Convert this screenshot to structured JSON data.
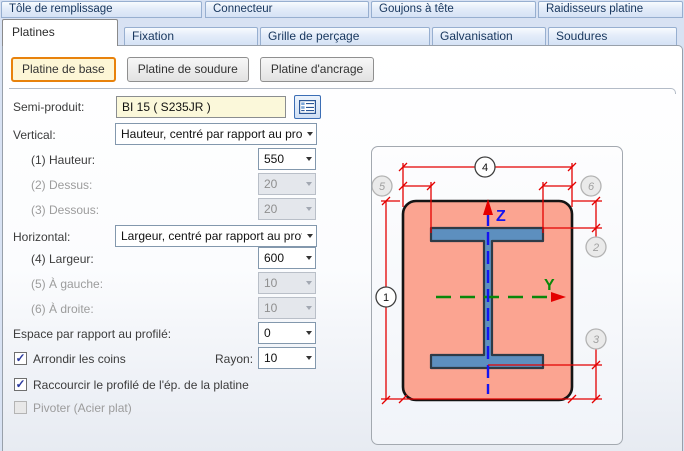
{
  "tabs_row1": [
    {
      "label": "Tôle de remplissage"
    },
    {
      "label": "Connecteur"
    },
    {
      "label": "Goujons à tête"
    },
    {
      "label": "Raidisseurs platine"
    }
  ],
  "tabs_row2": [
    {
      "label": "Platines",
      "active": true
    },
    {
      "label": "Fixation"
    },
    {
      "label": "Grille de perçage"
    },
    {
      "label": "Galvanisation"
    },
    {
      "label": "Soudures"
    }
  ],
  "plate_buttons": [
    {
      "label": "Platine de base",
      "active": true
    },
    {
      "label": "Platine de soudure"
    },
    {
      "label": "Platine d'ancrage"
    }
  ],
  "form": {
    "semi_produit": {
      "label": "Semi-produit:",
      "value": "BI 15  ( S235JR )"
    },
    "vertical": {
      "label": "Vertical:",
      "value": "Hauteur, centré par rapport au profilé"
    },
    "hauteur": {
      "label": "(1) Hauteur:",
      "value": "550"
    },
    "dessus": {
      "label": "(2) Dessus:",
      "value": "20"
    },
    "dessous": {
      "label": "(3) Dessous:",
      "value": "20"
    },
    "horizontal": {
      "label": "Horizontal:",
      "value": "Largeur, centré par rapport au profilé"
    },
    "largeur": {
      "label": "(4) Largeur:",
      "value": "600"
    },
    "a_gauche": {
      "label": "(5) À gauche:",
      "value": "10"
    },
    "a_droite": {
      "label": "(6) À droite:",
      "value": "10"
    },
    "espace": {
      "label": "Espace par rapport au profilé:",
      "value": "0"
    },
    "arrondir": {
      "label": "Arrondir les coins",
      "checked": true
    },
    "rayon": {
      "label": "Rayon:",
      "value": "10"
    },
    "raccourcir": {
      "label": "Raccourcir le profilé de l'ép. de la platine",
      "checked": true
    },
    "pivoter": {
      "label": "Pivoter (Acier plat)",
      "checked": false
    }
  },
  "diagram": {
    "axes": {
      "z": "Z",
      "y": "Y"
    },
    "callouts": [
      {
        "n": "4",
        "state": "active"
      },
      {
        "n": "5",
        "state": "disabled"
      },
      {
        "n": "6",
        "state": "disabled"
      },
      {
        "n": "1",
        "state": "active"
      },
      {
        "n": "2",
        "state": "disabled"
      },
      {
        "n": "3",
        "state": "disabled"
      }
    ],
    "colors": {
      "plate_fill": "#fba491",
      "beam_fill": "#5d8fbf",
      "dimension": "#e40000",
      "axis_z": "#1414f0",
      "axis_y": "#0a870a"
    }
  }
}
